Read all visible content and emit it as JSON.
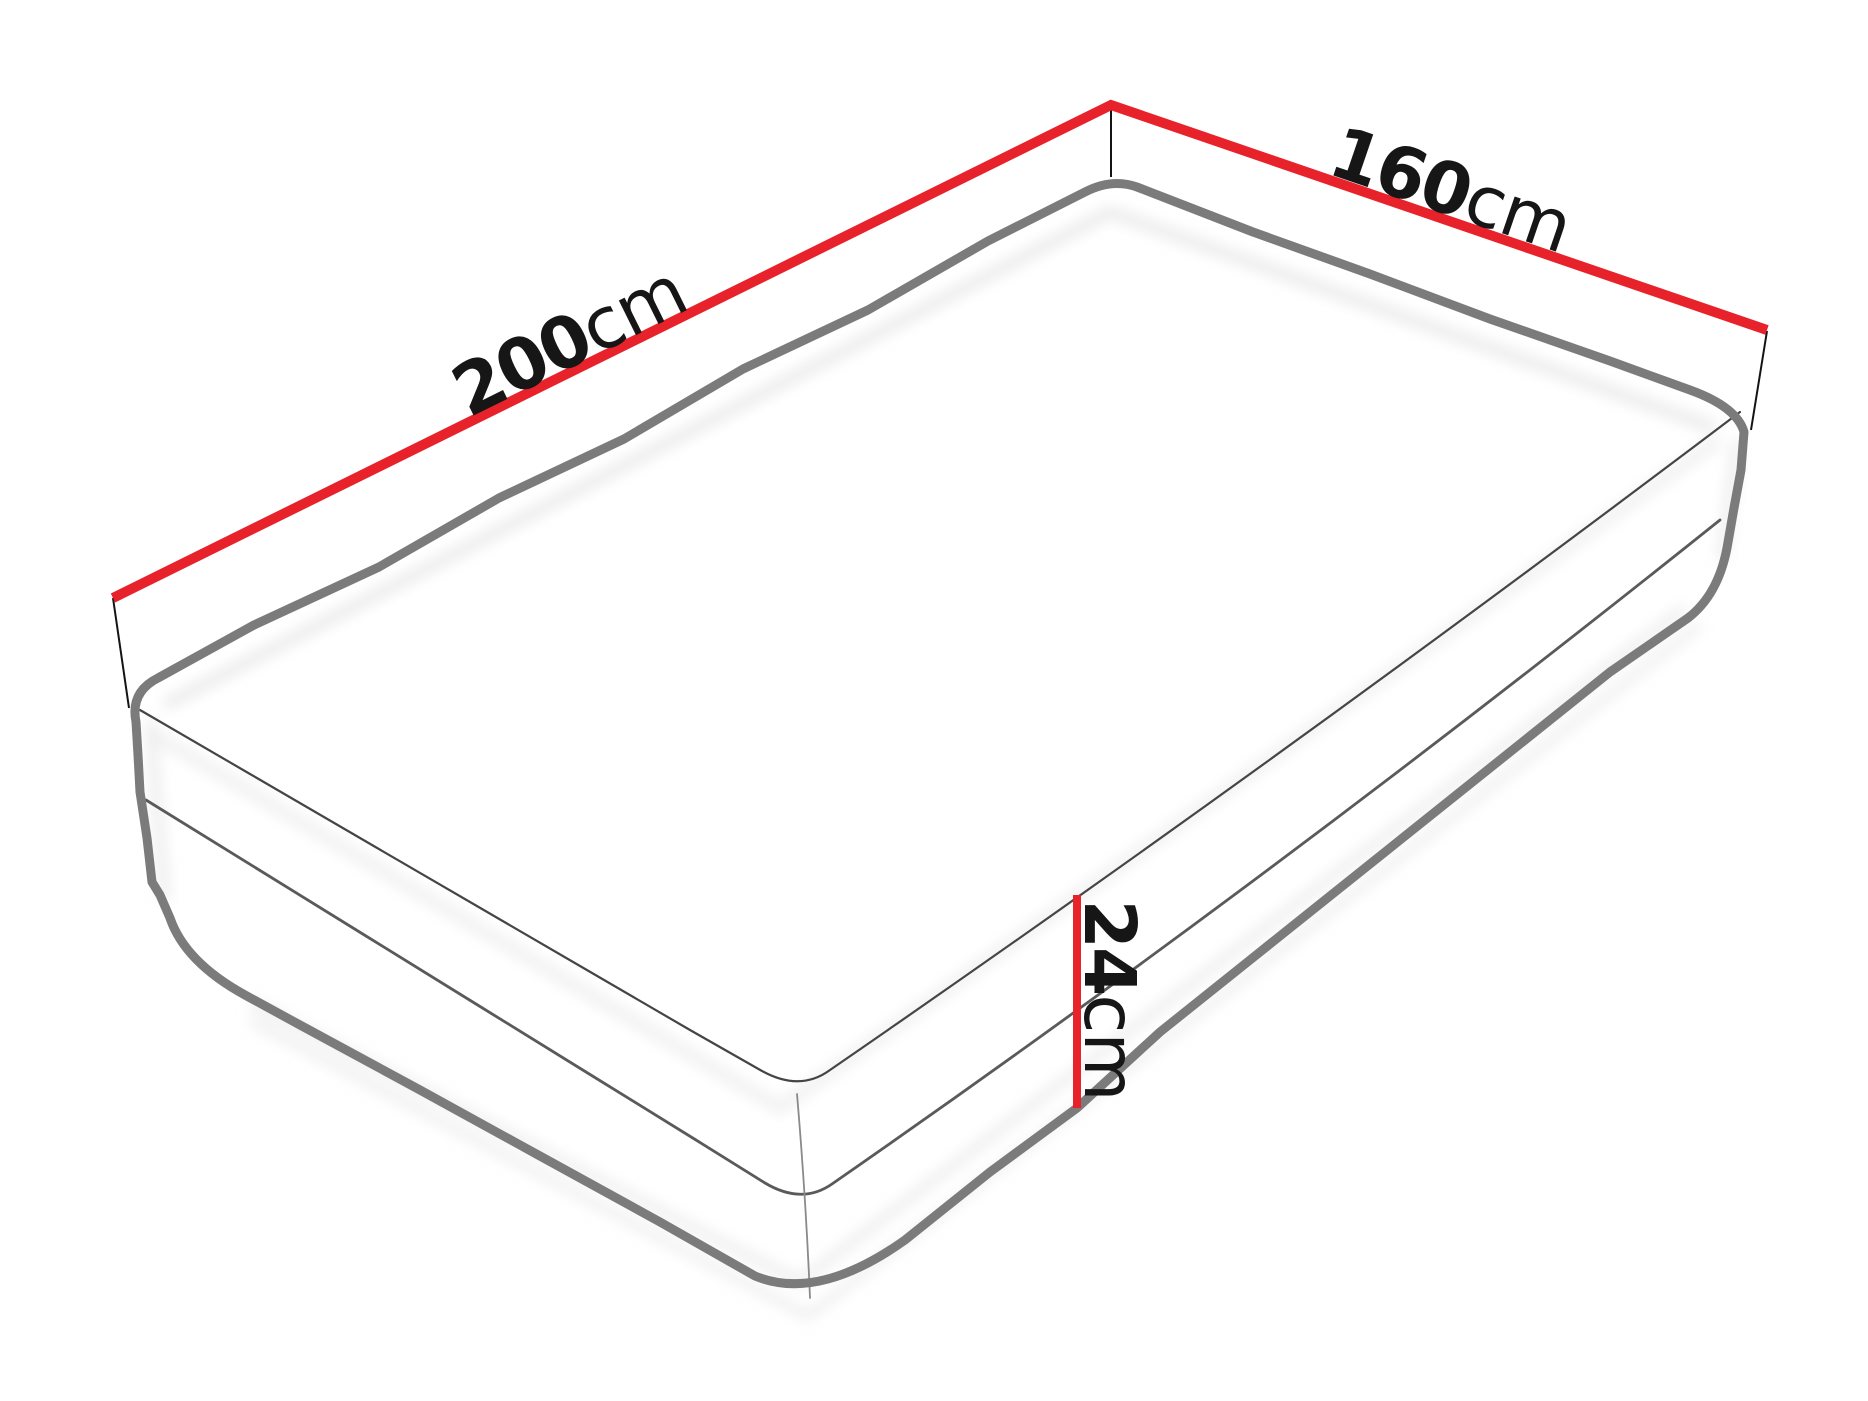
{
  "diagram": {
    "name": "mattress-dimensions-diagram",
    "labels": {
      "length": {
        "value": "200",
        "unit": "cm"
      },
      "width": {
        "value": "160",
        "unit": "cm"
      },
      "height": {
        "value": "24",
        "unit": "cm"
      }
    },
    "colors": {
      "dimension_line": "#e8222b",
      "outline_gray": "#7b7b7b",
      "seam_gray": "#4a4a4a",
      "corner_seam_gray": "#8a8a8a",
      "extension_black": "#141414",
      "text_black": "#161616",
      "background": "#ffffff"
    }
  }
}
